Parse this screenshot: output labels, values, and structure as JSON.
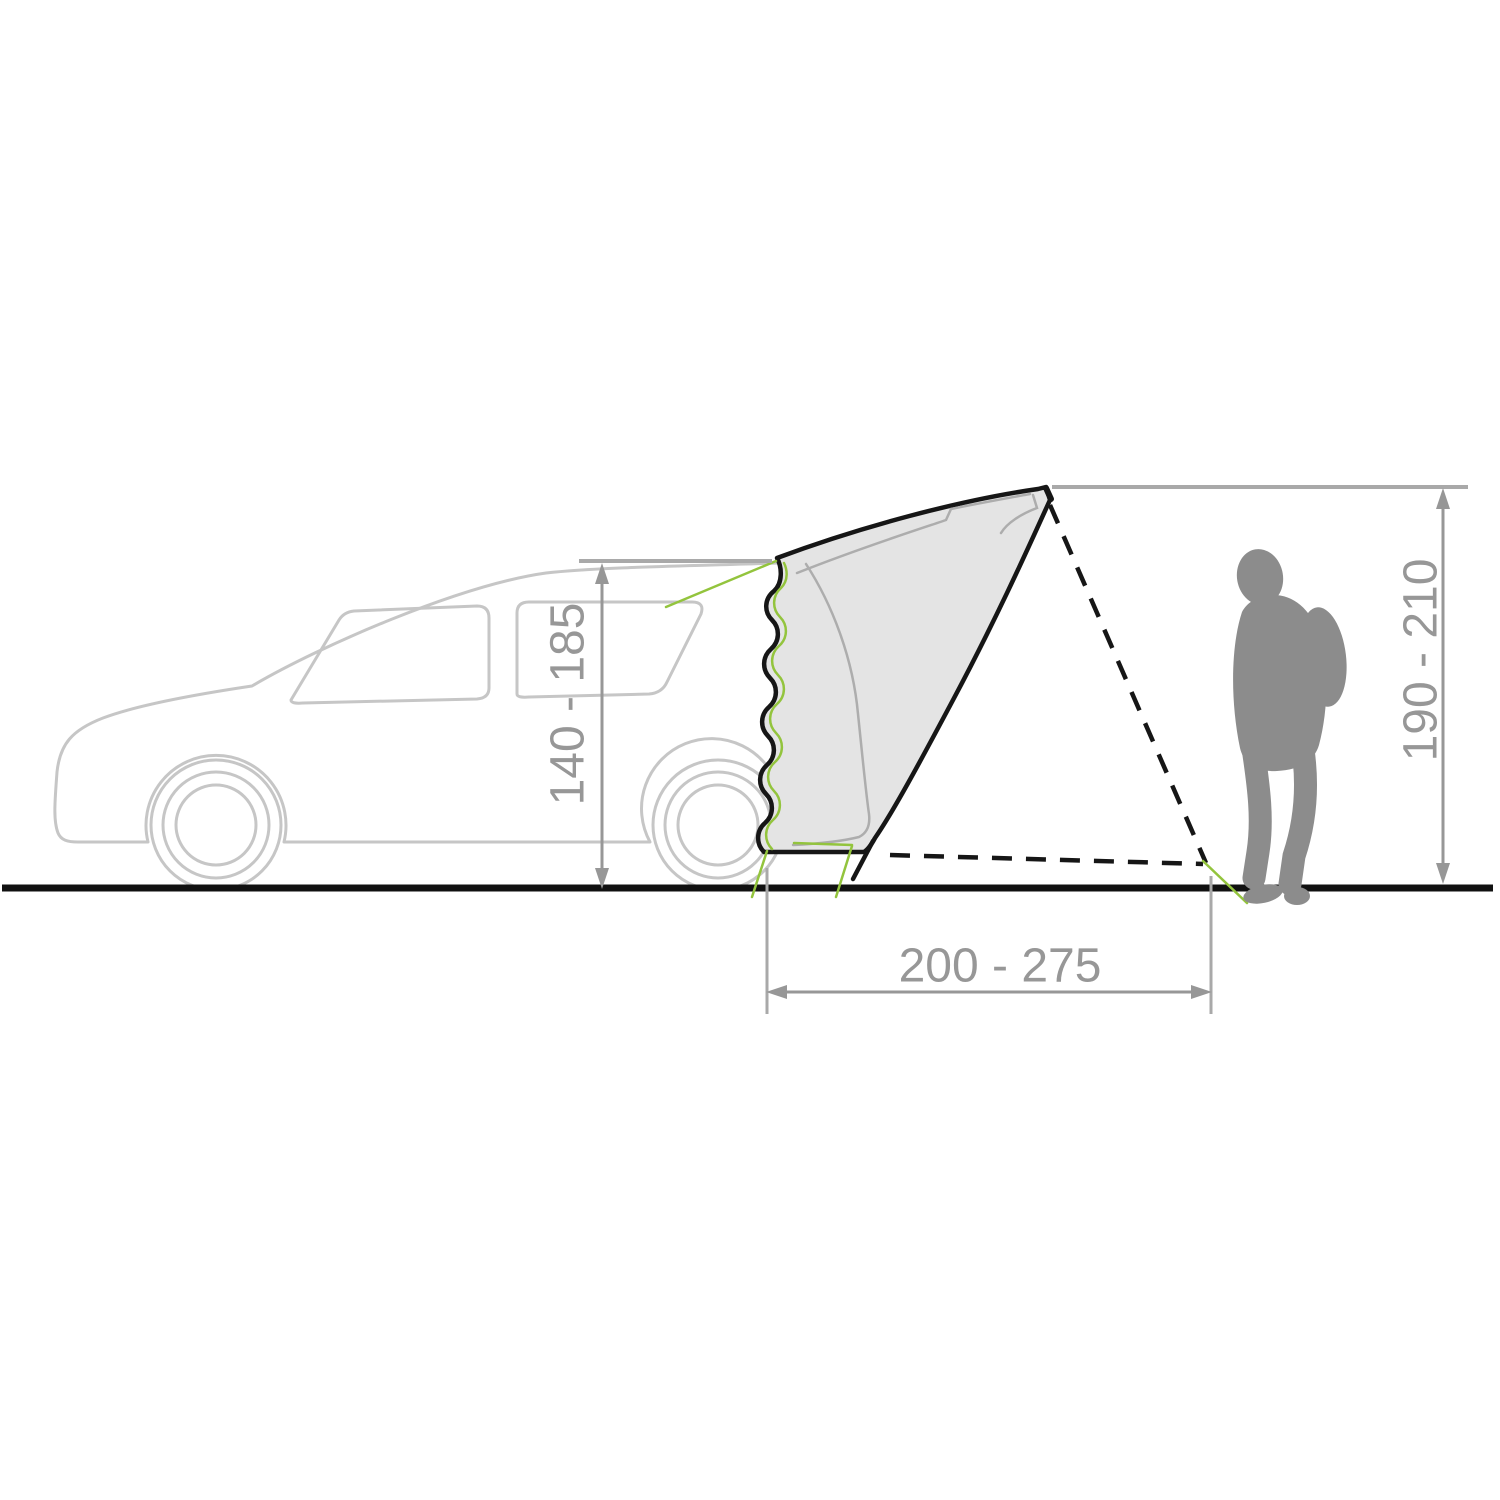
{
  "diagram": {
    "type": "technical-dimension-diagram",
    "subject": "tailgate tent attached to rear hatch of a car, person silhouette for scale",
    "dimensions": {
      "left": {
        "label": "140 - 185",
        "orientation": "vertical",
        "measures": "car rear attachment height"
      },
      "right": {
        "label": "190 - 210",
        "orientation": "vertical",
        "measures": "tent peak height"
      },
      "bottom": {
        "label": "200 - 275",
        "orientation": "horizontal",
        "measures": "tent footprint depth"
      }
    },
    "parts": {
      "car": "car-outline-silhouette",
      "tent": "tailgate-tent-side-view",
      "zipper": "wavy-zipper-connection",
      "guy_lines": "dashed-guy-lines-to-stake",
      "pegs": "green-peg-lines",
      "person": "person-silhouette-with-backpack",
      "ground": "ground-line"
    },
    "colors": {
      "background": "#ffffff",
      "car_outline": "#c6c6c6",
      "tent_fill": "#e4e4e4",
      "tent_outline": "#161616",
      "tent_inner_line": "#adadad",
      "dimension": "#979797",
      "extension_line": "#a9a9a9",
      "green_line": "#93c43d",
      "person": "#8c8c8c",
      "ground": "#111111"
    }
  }
}
